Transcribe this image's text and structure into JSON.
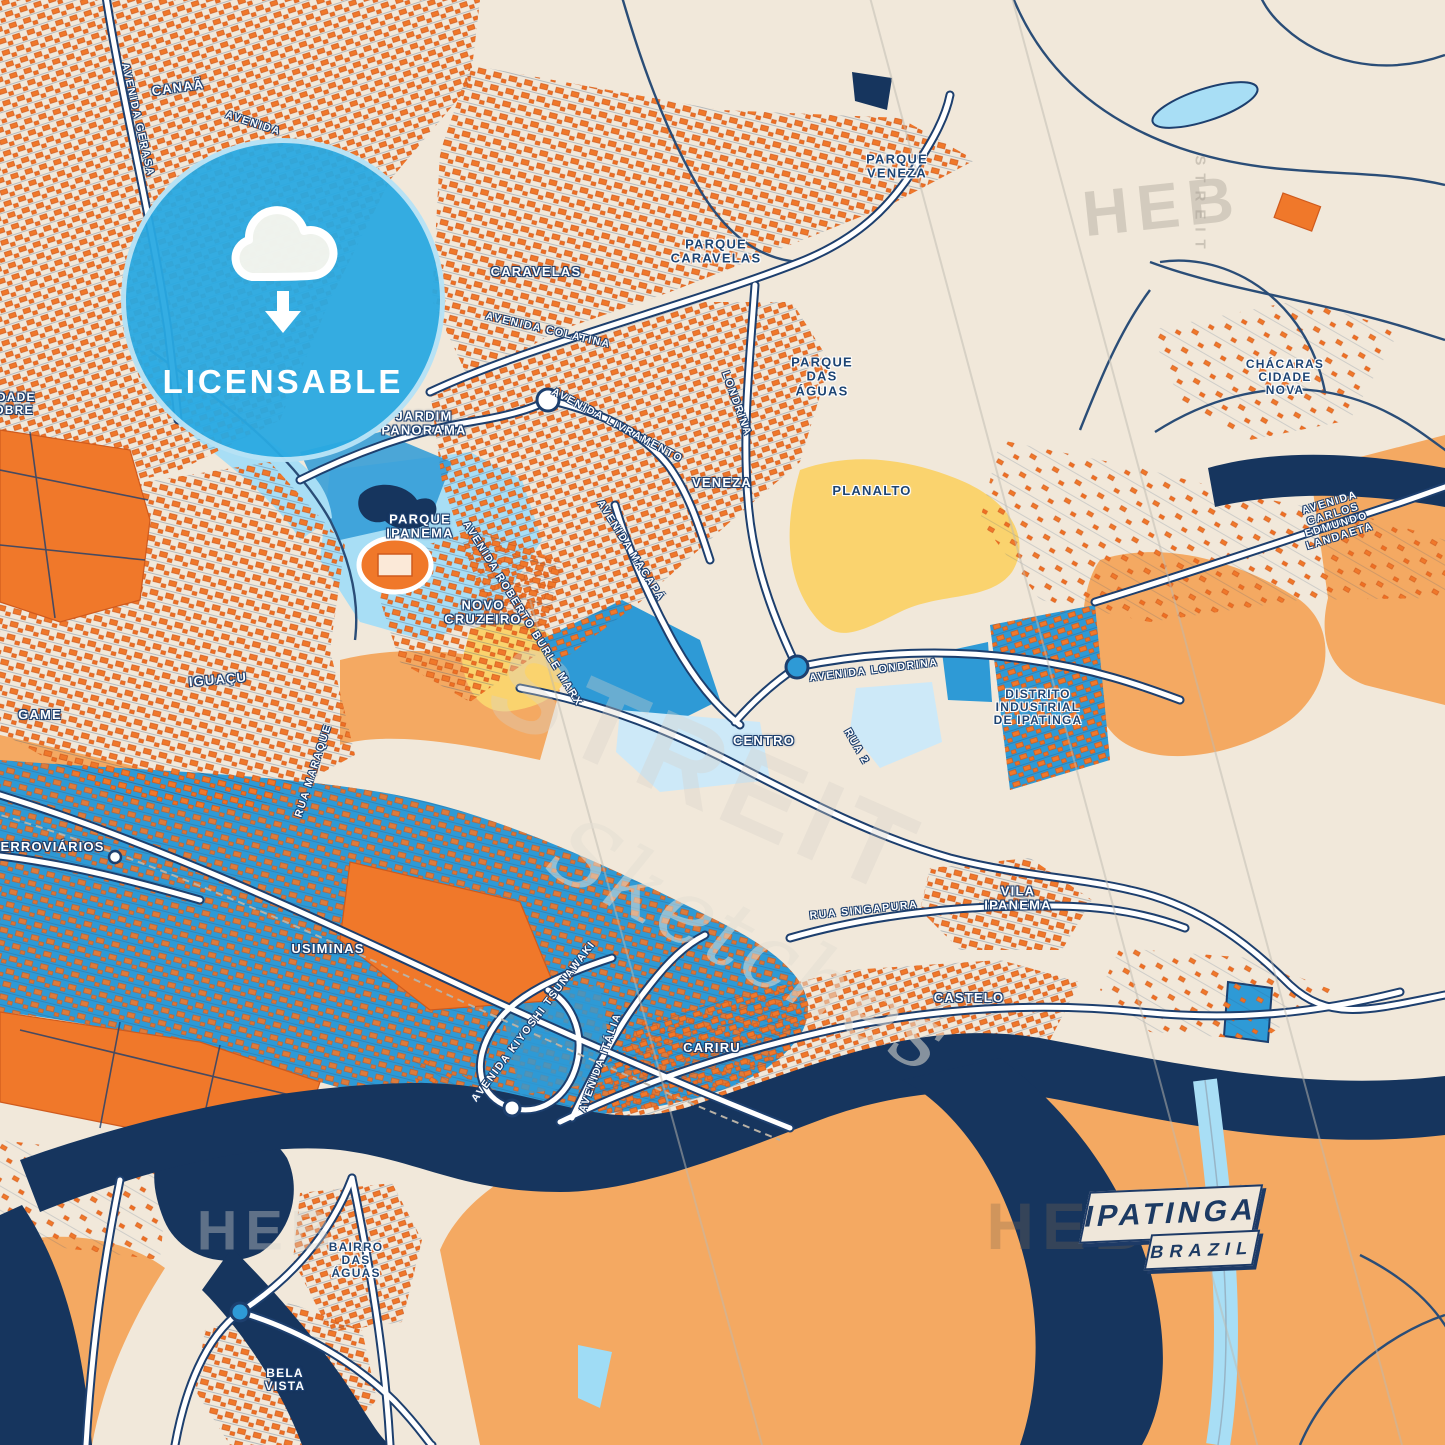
{
  "badge": {
    "label": "LICENSABLE",
    "icon": "cloud-download-icon"
  },
  "title_card": {
    "city": "IPATINGA",
    "country": "BRAZIL"
  },
  "watermarks": [
    {
      "text": "HEB",
      "x": 1162,
      "y": 206,
      "rot": -6,
      "size": 64,
      "style": "block",
      "color": "rgba(168,160,148,0.40)"
    },
    {
      "text": "STREIT",
      "x": 1200,
      "y": 206,
      "rot": 90,
      "size": 15,
      "style": "block",
      "color": "rgba(168,160,148,0.50)"
    },
    {
      "text": "STREIT",
      "x": 705,
      "y": 770,
      "rot": 24,
      "size": 115,
      "style": "block",
      "color": "rgba(215,210,200,0.35)"
    },
    {
      "text": "Sketches",
      "x": 750,
      "y": 945,
      "rot": 28,
      "size": 92,
      "style": "script",
      "color": "rgba(228,223,212,0.55)"
    },
    {
      "text": "HEB",
      "x": 1068,
      "y": 1226,
      "rot": 0,
      "size": 66,
      "style": "block",
      "color": "rgba(126,102,78,0.30)"
    },
    {
      "text": "STREI",
      "x": 1243,
      "y": 1226,
      "rot": 90,
      "size": 15,
      "style": "block",
      "color": "rgba(126,102,78,0.35)"
    },
    {
      "text": "HEB",
      "x": 268,
      "y": 1230,
      "rot": 0,
      "size": 56,
      "style": "block",
      "color": "rgba(215,212,205,0.38)"
    }
  ],
  "labels": [
    {
      "text": "CANAÃ",
      "x": 178,
      "y": 88,
      "rot": -8,
      "size": 13,
      "style": "area"
    },
    {
      "text": "AVENIDA GERASA",
      "x": 137,
      "y": 120,
      "rot": 77,
      "size": 10.5,
      "style": "road"
    },
    {
      "text": "AVENIDA",
      "x": 253,
      "y": 124,
      "rot": 18,
      "size": 10.5,
      "style": "road"
    },
    {
      "text": "PARQUE\nVENEZA",
      "x": 897,
      "y": 167,
      "rot": 0,
      "size": 13,
      "style": "park"
    },
    {
      "text": "PARQUE\nCARAVELAS",
      "x": 716,
      "y": 252,
      "rot": 0,
      "size": 13,
      "style": "park"
    },
    {
      "text": "CARAVELAS",
      "x": 536,
      "y": 272,
      "rot": 0,
      "size": 13,
      "style": "area"
    },
    {
      "text": "AVENIDA COLATINA",
      "x": 548,
      "y": 331,
      "rot": 13,
      "size": 10.5,
      "style": "road"
    },
    {
      "text": "JARDIM\nPANORAMA",
      "x": 424,
      "y": 424,
      "rot": 0,
      "size": 13,
      "style": "area"
    },
    {
      "text": "AVENIDA LIVRAMENTO",
      "x": 617,
      "y": 426,
      "rot": 28,
      "size": 10.5,
      "style": "road"
    },
    {
      "text": "LONDRINA",
      "x": 736,
      "y": 404,
      "rot": 70,
      "size": 10.5,
      "style": "road"
    },
    {
      "text": "VENEZA",
      "x": 722,
      "y": 483,
      "rot": 0,
      "size": 13,
      "style": "area"
    },
    {
      "text": "PLANALTO",
      "x": 872,
      "y": 491,
      "rot": 0,
      "size": 13,
      "style": "park"
    },
    {
      "text": "PARQUE\nDAS\nÁGUAS",
      "x": 822,
      "y": 377,
      "rot": 0,
      "size": 13,
      "style": "park"
    },
    {
      "text": "CHÁCARAS\nCIDADE\nNOVA",
      "x": 1285,
      "y": 378,
      "rot": 0,
      "size": 12,
      "style": "park"
    },
    {
      "text": "AVENIDA CARLOS EDMUNDO LANDAETA",
      "x": 1335,
      "y": 520,
      "rot": -17,
      "size": 10.5,
      "style": "road"
    },
    {
      "text": "PARQUE\nIPANEMA",
      "x": 420,
      "y": 527,
      "rot": 0,
      "size": 13,
      "style": "area"
    },
    {
      "text": "NOVO\nCRUZEIRO",
      "x": 483,
      "y": 613,
      "rot": 0,
      "size": 13,
      "style": "area"
    },
    {
      "text": "AVENIDA ROBERTO BURLE MARX",
      "x": 522,
      "y": 614,
      "rot": 58,
      "size": 10.5,
      "style": "road"
    },
    {
      "text": "AVENIDA MACAPÁ",
      "x": 630,
      "y": 551,
      "rot": 58,
      "size": 10.5,
      "style": "road"
    },
    {
      "text": "IGUAÇU",
      "x": 218,
      "y": 680,
      "rot": -5,
      "size": 13,
      "style": "area"
    },
    {
      "text": "GAME",
      "x": 40,
      "y": 715,
      "rot": 0,
      "size": 13,
      "style": "area"
    },
    {
      "text": "CENTRO",
      "x": 764,
      "y": 741,
      "rot": 0,
      "size": 13,
      "style": "area"
    },
    {
      "text": "RUA 2",
      "x": 856,
      "y": 747,
      "rot": 60,
      "size": 10.5,
      "style": "road"
    },
    {
      "text": "AVENIDA LONDRINA",
      "x": 874,
      "y": 671,
      "rot": -7,
      "size": 10.5,
      "style": "road"
    },
    {
      "text": "DISTRITO\nINDUSTRIAL\nDE IPATINGA",
      "x": 1038,
      "y": 708,
      "rot": 0,
      "size": 12,
      "style": "park"
    },
    {
      "text": "FERROVIÁRIOS",
      "x": 48,
      "y": 847,
      "rot": 0,
      "size": 13,
      "style": "area"
    },
    {
      "text": "RUA MARAQUE",
      "x": 314,
      "y": 771,
      "rot": -72,
      "size": 10.5,
      "style": "road"
    },
    {
      "text": "USIMINAS",
      "x": 328,
      "y": 949,
      "rot": 0,
      "size": 13,
      "style": "area"
    },
    {
      "text": "VILA\nIPANEMA",
      "x": 1018,
      "y": 899,
      "rot": 0,
      "size": 13,
      "style": "area"
    },
    {
      "text": "RUA SINGAPURA",
      "x": 864,
      "y": 911,
      "rot": -6,
      "size": 10.5,
      "style": "road"
    },
    {
      "text": "CASTELO",
      "x": 969,
      "y": 998,
      "rot": 0,
      "size": 13,
      "style": "area"
    },
    {
      "text": "CARIRU",
      "x": 712,
      "y": 1048,
      "rot": 0,
      "size": 13,
      "style": "area"
    },
    {
      "text": "AVENIDA ITÁLIA",
      "x": 601,
      "y": 1063,
      "rot": -70,
      "size": 10.5,
      "style": "road"
    },
    {
      "text": "AVENIDA KIYOSHI TSUNAWAKI",
      "x": 534,
      "y": 1022,
      "rot": -53,
      "size": 10.5,
      "style": "road"
    },
    {
      "text": "BAIRRO\nDAS\nÁGUAS",
      "x": 356,
      "y": 1261,
      "rot": 0,
      "size": 12,
      "style": "park"
    },
    {
      "text": "BELA\nVISTA",
      "x": 285,
      "y": 1380,
      "rot": 0,
      "size": 12,
      "style": "area"
    },
    {
      "text": "IDADE\nOBRE",
      "x": 14,
      "y": 404,
      "rot": 0,
      "size": 12,
      "style": "area"
    }
  ],
  "palette": {
    "background": "#f1e8da",
    "buildings": "#f0782a",
    "building_edge": "#cf5a1d",
    "water_medium": "#2e9ad6",
    "water_dark": "#16355e",
    "water_light": "#a8def5",
    "water_pale": "#cde9f8",
    "terrain_sand": "#f4a962",
    "park_yellow": "#fad36e",
    "road_fill": "#ffffff",
    "road_casing": "#1d3f6e",
    "badge_blue": "#29a9e2",
    "label_navy": "#1d4473"
  }
}
